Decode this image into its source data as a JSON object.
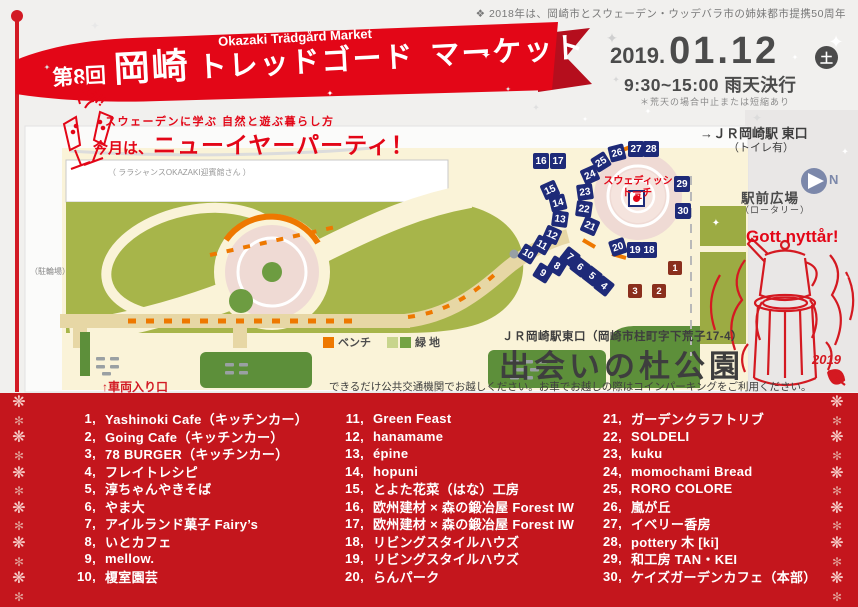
{
  "header": {
    "note": "❖ 2018年は、岡崎市とスウェーデン・ウッデバラ市の姉妹都市提携50周年",
    "banner": {
      "en_title": "Okazaki Trädgård Market",
      "edition": "第8回",
      "city": "岡崎",
      "kana1": "トレッドゴード",
      "kana2": "マーケット",
      "skal": "Skål!"
    },
    "date": {
      "year": "2019.",
      "day": "01.12",
      "weekday": "土",
      "time": "9:30~15:00 雨天決行",
      "note": "＊荒天の場合中止または短縮あり"
    }
  },
  "tagline": {
    "line1": "スウェーデンに学ぶ 自然と遊ぶ暮らし方",
    "line2_prefix": "今月は、",
    "line2_main": "ニューイヤーパーティ！"
  },
  "map": {
    "facility_label": "（ ララシャンスOKAZAKI迎賓館さん ）",
    "bike_parking": "（駐輪場）",
    "vehicle_entrance": "↑車両入り口",
    "torch_label_line1": "スウェディッシュ",
    "torch_label_line2": "トーチ",
    "legend": {
      "bench": "ベンチ",
      "green": "緑 地"
    },
    "right_panel": {
      "station": "→ＪＲ岡崎駅 東口",
      "station_note": "（トイレ有）",
      "compass_n": "N",
      "square": "駅前広場",
      "square_note": "（ロータリー）",
      "greeting": "Gott nyttår!",
      "year_tag": "2019"
    },
    "venue": {
      "station_line": "ＪＲ岡崎駅東口（岡崎市柱町字下荒子17-4）",
      "name": "出会いの杜公園",
      "transport_note": "できるだけ公共交通機関でお越しください。お車でお越しの際はコインパーキングをご利用ください。"
    },
    "markers": [
      {
        "n": "1",
        "x": 675,
        "y": 268,
        "r": 0,
        "c": "maroon"
      },
      {
        "n": "2",
        "x": 659,
        "y": 291,
        "r": 0,
        "c": "maroon"
      },
      {
        "n": "3",
        "x": 635,
        "y": 291,
        "r": 0,
        "c": "maroon"
      },
      {
        "n": "4",
        "x": 604,
        "y": 286,
        "r": 38,
        "c": "navy"
      },
      {
        "n": "5",
        "x": 592,
        "y": 276,
        "r": 38,
        "c": "navy"
      },
      {
        "n": "6",
        "x": 580,
        "y": 267,
        "r": 38,
        "c": "navy"
      },
      {
        "n": "7",
        "x": 570,
        "y": 257,
        "r": 38,
        "c": "navy"
      },
      {
        "n": "8",
        "x": 557,
        "y": 266,
        "r": 32,
        "c": "navy"
      },
      {
        "n": "9",
        "x": 543,
        "y": 273,
        "r": 32,
        "c": "navy"
      },
      {
        "n": "10",
        "x": 528,
        "y": 254,
        "r": 32,
        "c": "navy"
      },
      {
        "n": "11",
        "x": 542,
        "y": 245,
        "r": 30,
        "c": "navy"
      },
      {
        "n": "12",
        "x": 552,
        "y": 235,
        "r": 24,
        "c": "navy"
      },
      {
        "n": "13",
        "x": 560,
        "y": 219,
        "r": 8,
        "c": "navy"
      },
      {
        "n": "14",
        "x": 558,
        "y": 203,
        "r": -14,
        "c": "navy"
      },
      {
        "n": "15",
        "x": 550,
        "y": 190,
        "r": -24,
        "c": "navy"
      },
      {
        "n": "16",
        "x": 541,
        "y": 161,
        "r": 0,
        "c": "navy"
      },
      {
        "n": "17",
        "x": 558,
        "y": 161,
        "r": 0,
        "c": "navy"
      },
      {
        "n": "18",
        "x": 649,
        "y": 250,
        "r": 0,
        "c": "navy"
      },
      {
        "n": "19",
        "x": 635,
        "y": 250,
        "r": 0,
        "c": "navy"
      },
      {
        "n": "20",
        "x": 618,
        "y": 247,
        "r": -18,
        "c": "navy"
      },
      {
        "n": "21",
        "x": 590,
        "y": 226,
        "r": 24,
        "c": "navy"
      },
      {
        "n": "22",
        "x": 584,
        "y": 209,
        "r": 8,
        "c": "navy"
      },
      {
        "n": "23",
        "x": 585,
        "y": 192,
        "r": -8,
        "c": "navy"
      },
      {
        "n": "24",
        "x": 590,
        "y": 175,
        "r": -24,
        "c": "navy"
      },
      {
        "n": "25",
        "x": 601,
        "y": 162,
        "r": -32,
        "c": "navy"
      },
      {
        "n": "26",
        "x": 617,
        "y": 153,
        "r": -14,
        "c": "navy"
      },
      {
        "n": "27",
        "x": 636,
        "y": 149,
        "r": 0,
        "c": "navy"
      },
      {
        "n": "28",
        "x": 651,
        "y": 149,
        "r": 0,
        "c": "navy"
      },
      {
        "n": "29",
        "x": 682,
        "y": 184,
        "r": 0,
        "c": "navy"
      },
      {
        "n": "30",
        "x": 683,
        "y": 211,
        "r": 0,
        "c": "navy"
      }
    ]
  },
  "vendors": {
    "columns": [
      [
        {
          "no": "1,",
          "name": "Yashinoki Cafe（キッチンカー）"
        },
        {
          "no": "2,",
          "name": "Going Cafe（キッチンカー）"
        },
        {
          "no": "3,",
          "name": "78 BURGER（キッチンカー）"
        },
        {
          "no": "4,",
          "name": "フレイトレシピ"
        },
        {
          "no": "5,",
          "name": "淳ちゃんやきそば"
        },
        {
          "no": "6,",
          "name": "やま大"
        },
        {
          "no": "7,",
          "name": "アイルランド菓子 Fairy’s"
        },
        {
          "no": "8,",
          "name": "いとカフェ"
        },
        {
          "no": "9,",
          "name": "mellow."
        },
        {
          "no": "10,",
          "name": "榎室園芸"
        }
      ],
      [
        {
          "no": "11,",
          "name": "Green Feast"
        },
        {
          "no": "12,",
          "name": "hanamame"
        },
        {
          "no": "13,",
          "name": "épine"
        },
        {
          "no": "14,",
          "name": "hopuni"
        },
        {
          "no": "15,",
          "name": "とよた花菜（はな）工房"
        },
        {
          "no": "16,",
          "name": "欧州建材 × 森の鍛冶屋 Forest IW"
        },
        {
          "no": "17,",
          "name": "欧州建材 × 森の鍛冶屋 Forest IW"
        },
        {
          "no": "18,",
          "name": "リビングスタイルハウズ"
        },
        {
          "no": "19,",
          "name": "リビングスタイルハウズ"
        },
        {
          "no": "20,",
          "name": "らんパーク"
        }
      ],
      [
        {
          "no": "21,",
          "name": "ガーデンクラフトリブ"
        },
        {
          "no": "22,",
          "name": "SOLDELI"
        },
        {
          "no": "23,",
          "name": "kuku"
        },
        {
          "no": "24,",
          "name": "momochami Bread"
        },
        {
          "no": "25,",
          "name": "RORO COLORE"
        },
        {
          "no": "26,",
          "name": "嵐が丘"
        },
        {
          "no": "27,",
          "name": "イベリー香房"
        },
        {
          "no": "28,",
          "name": "pottery 木 [ki]"
        },
        {
          "no": "29,",
          "name": "和工房 TAN・KEI"
        },
        {
          "no": "30,",
          "name": "ケイズガーデンカフェ（本部）"
        }
      ]
    ]
  },
  "decor": {
    "sparkle_glyph": "✦",
    "sparkles": [
      [
        612,
        38,
        14,
        "#cfcfcf"
      ],
      [
        616,
        80,
        9,
        "#d8d8d8"
      ],
      [
        836,
        42,
        18,
        "#ffffff"
      ],
      [
        486,
        55,
        12,
        "#ffffff"
      ],
      [
        536,
        108,
        9,
        "#e0e0e0"
      ],
      [
        562,
        16,
        9,
        "#dddddd"
      ],
      [
        718,
        14,
        10,
        "#eeeeee"
      ],
      [
        795,
        58,
        8,
        "#ffffff"
      ],
      [
        648,
        112,
        8,
        "#ffffff"
      ],
      [
        95,
        27,
        11,
        "#e8e8e8"
      ],
      [
        47,
        68,
        8,
        "#dddddd"
      ],
      [
        330,
        94,
        8,
        "#ffffff"
      ],
      [
        757,
        118,
        12,
        "#dcdcdc"
      ],
      [
        845,
        152,
        9,
        "#ffffff"
      ],
      [
        716,
        224,
        10,
        "#ffffff"
      ],
      [
        846,
        278,
        8,
        "#f3f3f3"
      ],
      [
        508,
        90,
        7,
        "#e5e5e5"
      ],
      [
        585,
        120,
        7,
        "#ffffff"
      ]
    ],
    "snow_glyphs": [
      "❋",
      "✻"
    ],
    "snow_count": 12
  },
  "colors": {
    "ribbon_red": "#e30617",
    "band_red": "#c4161d",
    "marker_navy": "#1e2a78",
    "marker_maroon": "#8a2f1d",
    "bench_orange": "#ee7800",
    "park_green": "#a7b54a",
    "dark_green": "#5d8f3a",
    "path_cream": "#faf3d8",
    "circle_pink": "#efdad4",
    "date_gray": "#4b4b4b"
  }
}
